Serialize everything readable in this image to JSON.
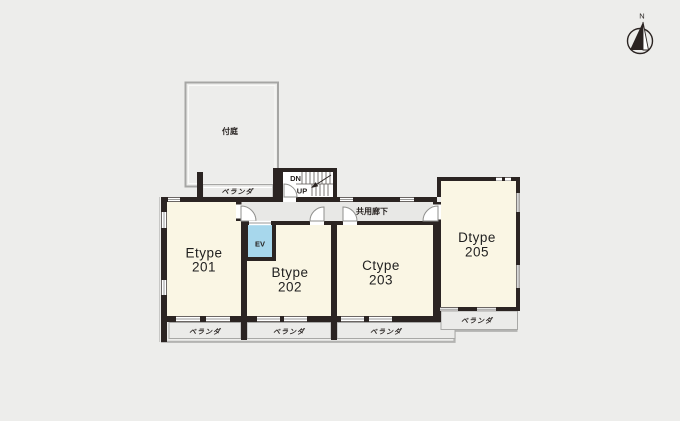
{
  "colors": {
    "background": "#ededeb",
    "wall": "#2b2422",
    "room_fill": "#faf6e4",
    "corridor_fill": "#e8e8e6",
    "veranda_fill": "#ebebe9",
    "elevator_fill": "#a7d7ec",
    "outline": "#b3b3b1",
    "border_gray": "#a6a6a4",
    "text": "#1f1f1f"
  },
  "compass": {
    "north_label": "N"
  },
  "garden": {
    "label": "付庭"
  },
  "upper_veranda": {
    "label": "ベランダ"
  },
  "stairwell": {
    "down_label": "DN",
    "up_label": "UP"
  },
  "corridor": {
    "label": "共用廊下"
  },
  "elevator": {
    "label": "EV"
  },
  "units": [
    {
      "type": "Etype",
      "number": "201",
      "veranda_label": "ベランダ"
    },
    {
      "type": "Btype",
      "number": "202",
      "veranda_label": "ベランダ"
    },
    {
      "type": "Ctype",
      "number": "203",
      "veranda_label": "ベランダ"
    },
    {
      "type": "Dtype",
      "number": "205",
      "veranda_label": "ベランダ"
    }
  ]
}
